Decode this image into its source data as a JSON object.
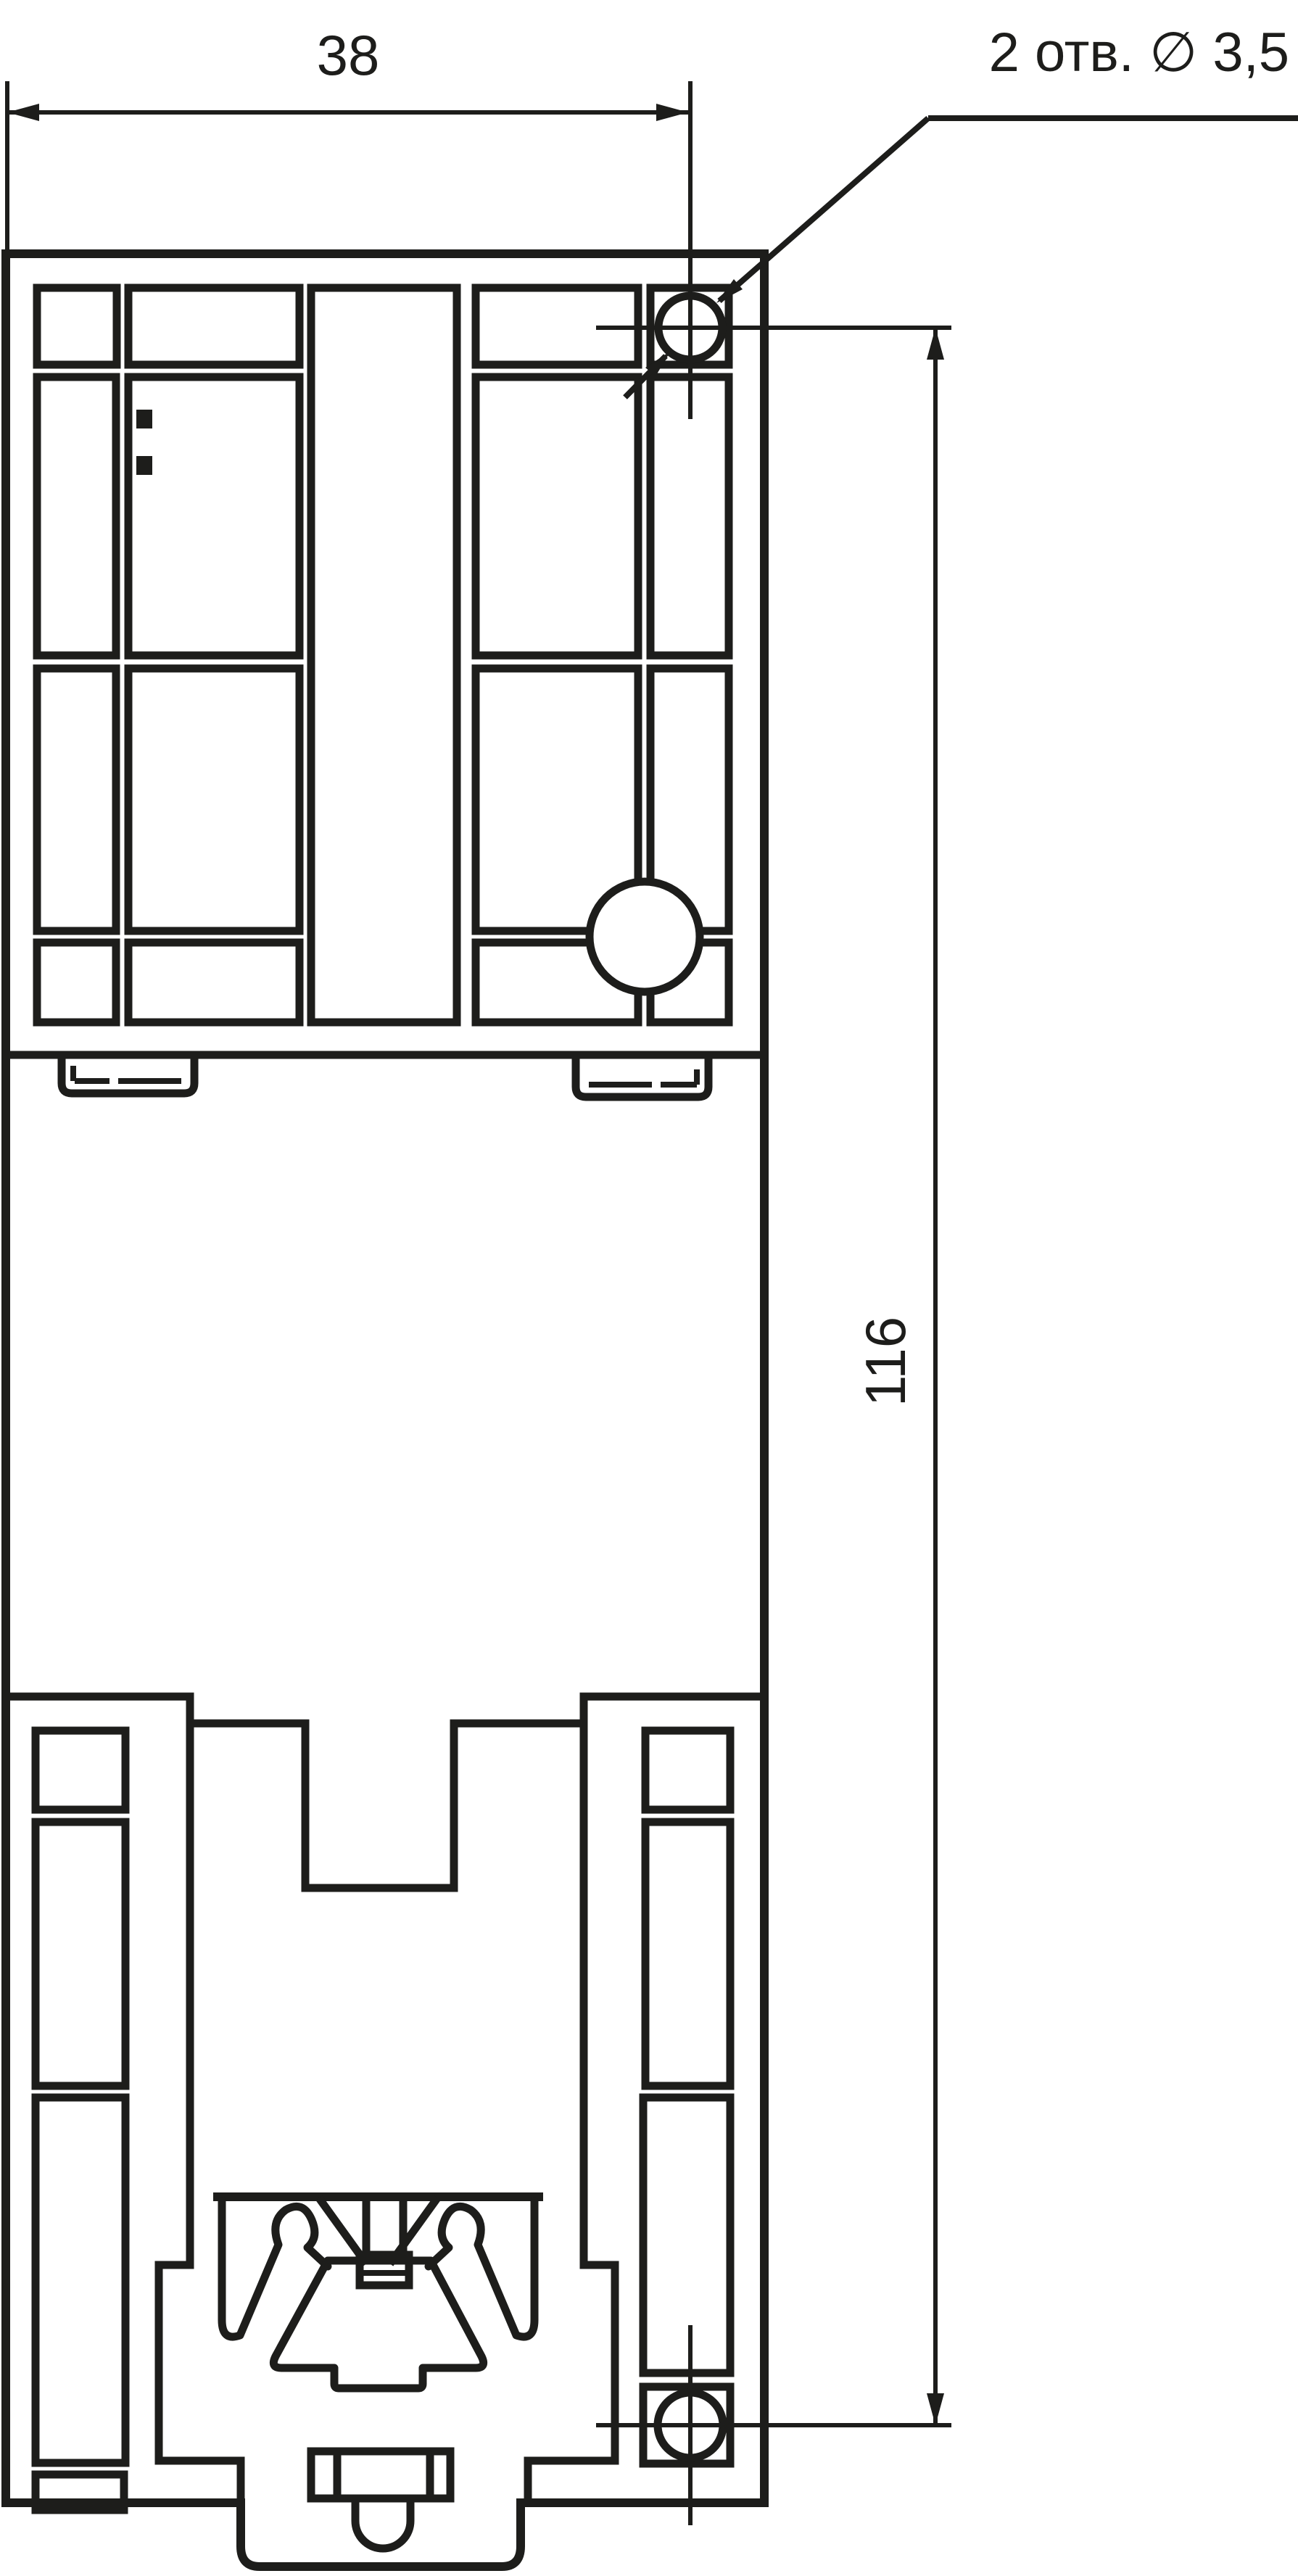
{
  "colors": {
    "background": "#ffffff",
    "line": "#1d1d1b"
  },
  "drawing": {
    "kind": "technical-dimension-drawing",
    "dimension_width": {
      "label": "38",
      "value_mm": 38
    },
    "dimension_height": {
      "label": "116",
      "value_mm": 116
    },
    "holes_callout": {
      "label": "2 отв. ∅ 3,5",
      "hole_count": 2,
      "hole_diameter_mm": 3.5
    }
  }
}
